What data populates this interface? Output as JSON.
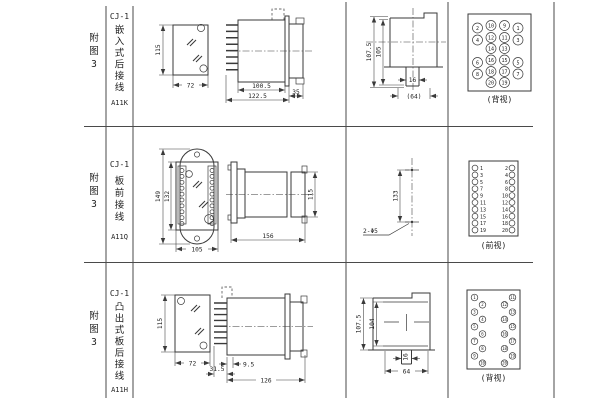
{
  "rows": [
    {
      "figure_chars": [
        "附",
        "图",
        "3"
      ],
      "model": "CJ-1",
      "type_chars": [
        "嵌",
        "入",
        "式",
        "后",
        "接",
        "线"
      ],
      "code": "A11K",
      "dims": {
        "height": "115",
        "width": "72",
        "body_len": "100.5",
        "total_len": "122.5",
        "bracket": "35",
        "panel_h1": "107.5",
        "panel_h2": "105",
        "stem": "16",
        "flange": "(64)"
      },
      "terminal_view": {
        "caption": "(背视)",
        "numbers": [
          [
            "2",
            "10",
            "9",
            "1"
          ],
          [
            "4",
            "12",
            "11",
            "3"
          ],
          [
            "14",
            "13"
          ],
          [
            "6",
            "16",
            "15",
            "5"
          ],
          [
            "8",
            "18",
            "17",
            "7"
          ],
          [
            "20",
            "19"
          ]
        ]
      }
    },
    {
      "figure_chars": [
        "附",
        "图",
        "3"
      ],
      "model": "CJ-1",
      "type_chars": [
        "板",
        "前",
        "接",
        "线"
      ],
      "code": "A11Q",
      "dims": {
        "outer_h": "149",
        "inner_h": "132",
        "width": "105",
        "length": "156",
        "height": "115",
        "hole_spacing": "133",
        "holes_label": "2-Φ5"
      },
      "terminal_view": {
        "caption": "(前视)",
        "left_numbers": [
          "1",
          "3",
          "5",
          "7",
          "9",
          "11",
          "13",
          "15",
          "17",
          "19"
        ],
        "right_numbers": [
          "2",
          "4",
          "6",
          "8",
          "10",
          "12",
          "14",
          "16",
          "18",
          "20"
        ]
      }
    },
    {
      "figure_chars": [
        "附",
        "图",
        "3"
      ],
      "model": "CJ-1",
      "type_chars": [
        "凸",
        "出",
        "式",
        "板",
        "后",
        "接",
        "线"
      ],
      "code": "A11H",
      "dims": {
        "height": "115",
        "width": "72",
        "offset": "9.5",
        "pins": "31.5",
        "length": "126",
        "panel_h1": "107.5",
        "panel_h2": "104",
        "stem": "16",
        "flange": "64"
      },
      "terminal_view": {
        "caption": "(背视)",
        "left_numbers": [
          "1",
          "2",
          "3",
          "4",
          "5",
          "6",
          "7",
          "8",
          "9",
          "10"
        ],
        "right_numbers": [
          "11",
          "12",
          "13",
          "14",
          "15",
          "16",
          "17",
          "18",
          "19",
          "20"
        ]
      }
    }
  ]
}
